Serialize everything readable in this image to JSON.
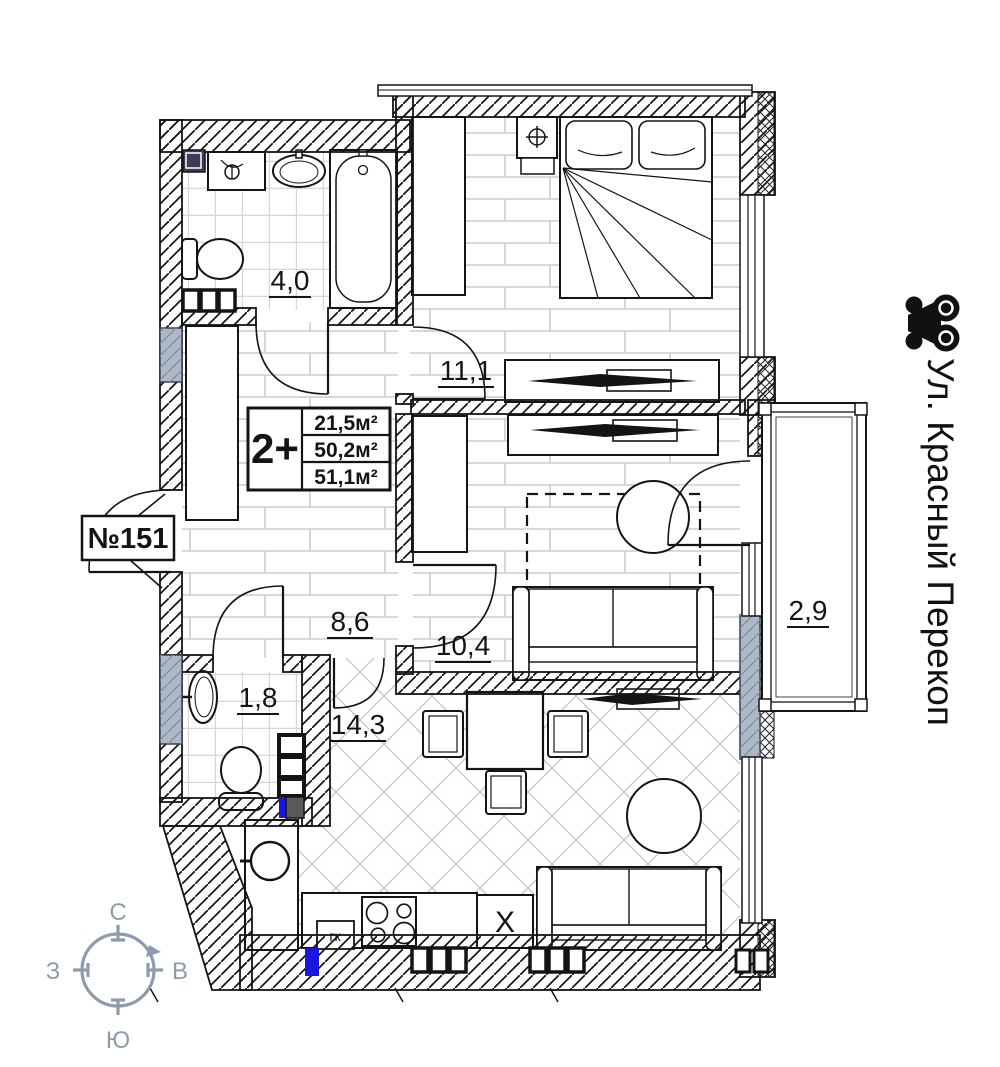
{
  "plan": {
    "apartment_label": "№151",
    "info_box": {
      "type": "2+",
      "living_area": "21,5м²",
      "apartment_area": "50,2м²",
      "total_area": "51,1м²"
    },
    "rooms": {
      "bathroom": "4,0",
      "bedroom": "11,1",
      "hall": "8,6",
      "living": "10,4",
      "kitchen": "14,3",
      "wc": "1,8",
      "balcony": "2,9"
    },
    "fixtures": {
      "boiler": "гк",
      "sink": "X"
    }
  },
  "street": {
    "name": "Ул. Красный Перекоп"
  },
  "compass": {
    "north": "С",
    "south": "Ю",
    "west": "З",
    "east": "В"
  },
  "colors": {
    "line": "#141414",
    "accent_blue": "#1a16dd",
    "navy_square": "#3b3b56",
    "wall_gray": "#aeb9c8",
    "dark_gray": "#5a5a5a",
    "compass": "#8d9cad",
    "floor_line": "#c9ccd1"
  }
}
